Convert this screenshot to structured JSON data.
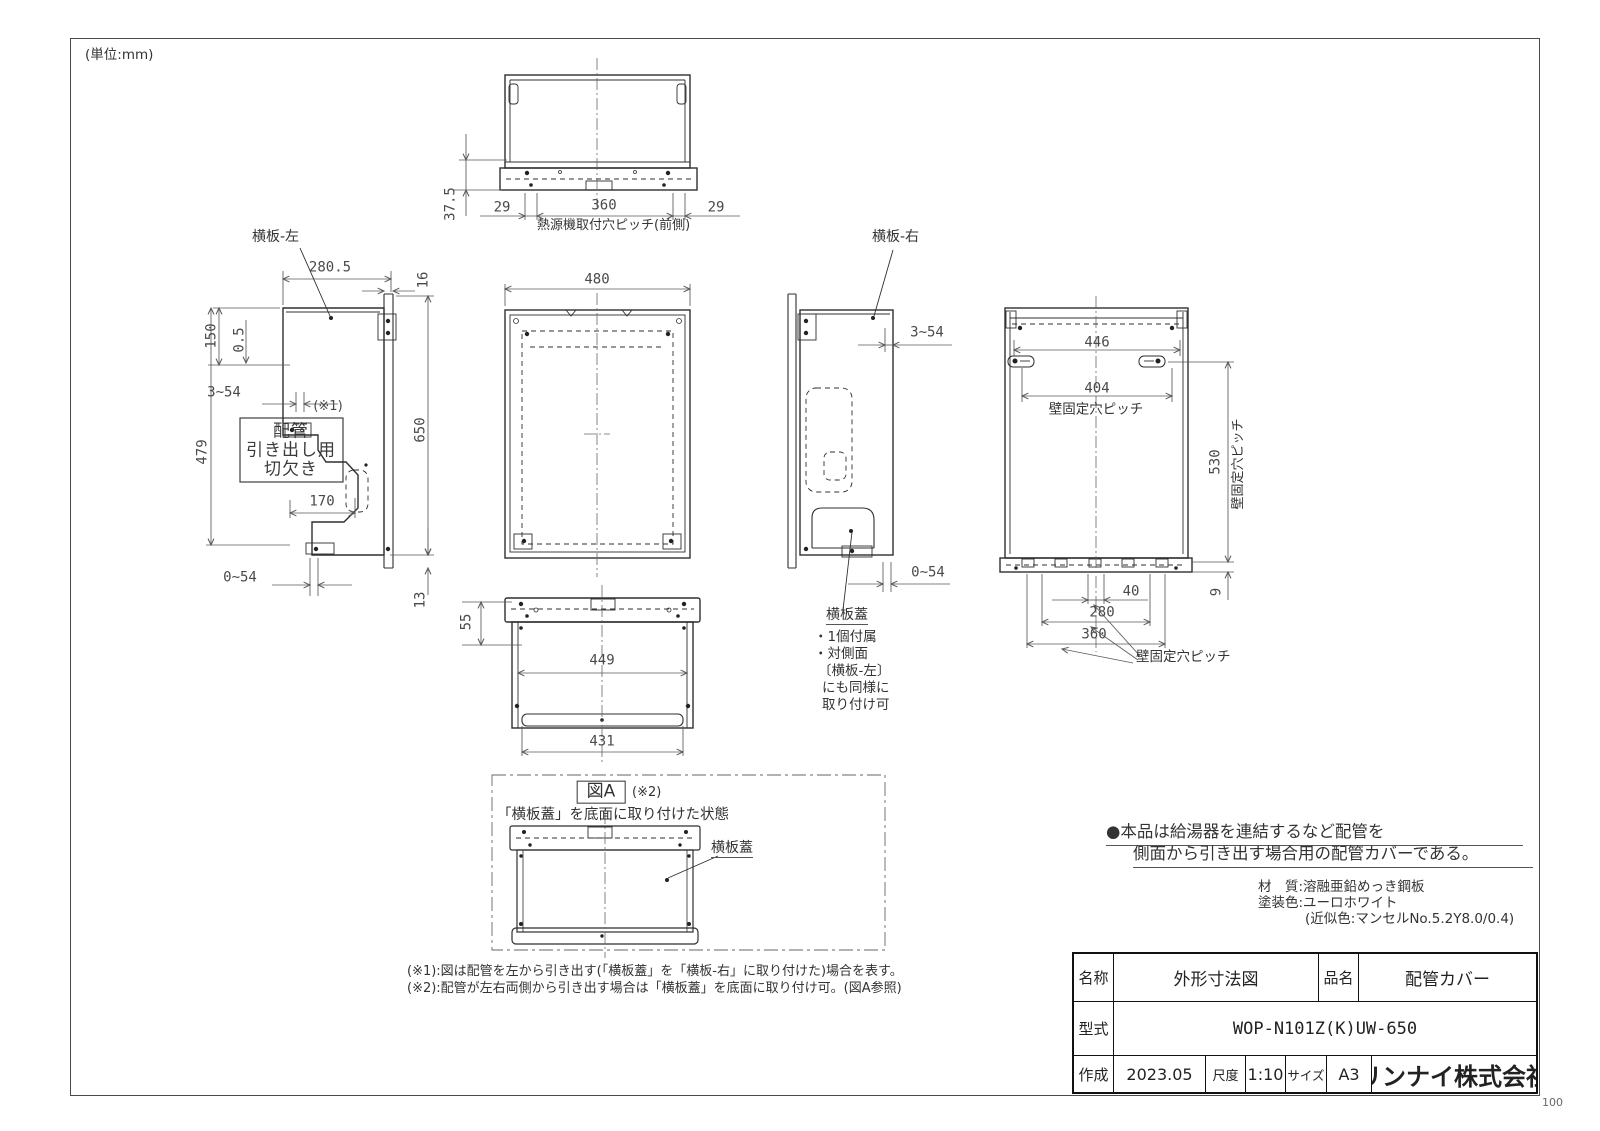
{
  "page": {
    "unit": "(単位:mm)",
    "page_num": "100"
  },
  "top_view": {
    "label": "熱源機取付穴ピッチ(前側)",
    "d29l": "29",
    "d360": "360",
    "d29r": "29",
    "d375": "37.5"
  },
  "left_view": {
    "title": "横板-左",
    "d2805": "280.5",
    "d16": "16",
    "d150": "150",
    "d05": "0.5",
    "r354": "3~54",
    "ref": "(※1)",
    "cut1": "配管",
    "cut2": "引き出し用",
    "cut3": "切欠き",
    "d479": "479",
    "d650": "650",
    "d170": "170",
    "r054": "0~54",
    "d13": "13"
  },
  "front_view": {
    "d480": "480"
  },
  "right_view": {
    "title": "横板-右",
    "r354": "3~54",
    "r054": "0~54",
    "cover": "横板蓋",
    "n1": "・1個付属",
    "n2": "・対側面",
    "n3": "〔横板-左〕",
    "n4": "にも同様に",
    "n5": "取り付け可"
  },
  "rear_view": {
    "d446": "446",
    "d404": "404",
    "pitch": "壁固定穴ピッチ",
    "d530": "530",
    "pitch_v": "壁固定穴ピッチ",
    "d9": "9",
    "d40": "40",
    "d280": "280",
    "d360": "360",
    "pitch_b": "壁固定穴ピッチ"
  },
  "bottom_view": {
    "d55": "55",
    "d449": "449",
    "d431": "431"
  },
  "fig_a": {
    "title": "図A",
    "ref": "(※2)",
    "subtitle": "「横板蓋」を底面に取り付けた状態",
    "cover": "横板蓋"
  },
  "notes": {
    "b1": "●本品は給湯器を連結するなど配管を",
    "b2": "側面から引き出す場合用の配管カバーである。",
    "m1": "材　質:溶融亜鉛めっき鋼板",
    "m2": "塗装色:ユーロホワイト",
    "m3": "(近似色:マンセルNo.5.2Y8.0/0.4)",
    "r1": "(※1):図は配管を左から引き出す(「横板蓋」を「横板-右」に取り付けた)場合を表す。",
    "r2": "(※2):配管が左右両側から引き出す場合は「横板蓋」を底面に取り付け可。(図A参照)"
  },
  "title_block": {
    "c1l": "名称",
    "c1v": "外形寸法図",
    "c2l": "品名",
    "c2v": "配管カバー",
    "c3l": "型式",
    "c3v": "WOP-N101Z(K)UW-650",
    "c4l": "作成",
    "c4v": "2023.05",
    "c5l": "尺度",
    "c5v": "1:10",
    "c6l": "サイズ",
    "c6v": "A3",
    "company": "リンナイ株式会社"
  }
}
